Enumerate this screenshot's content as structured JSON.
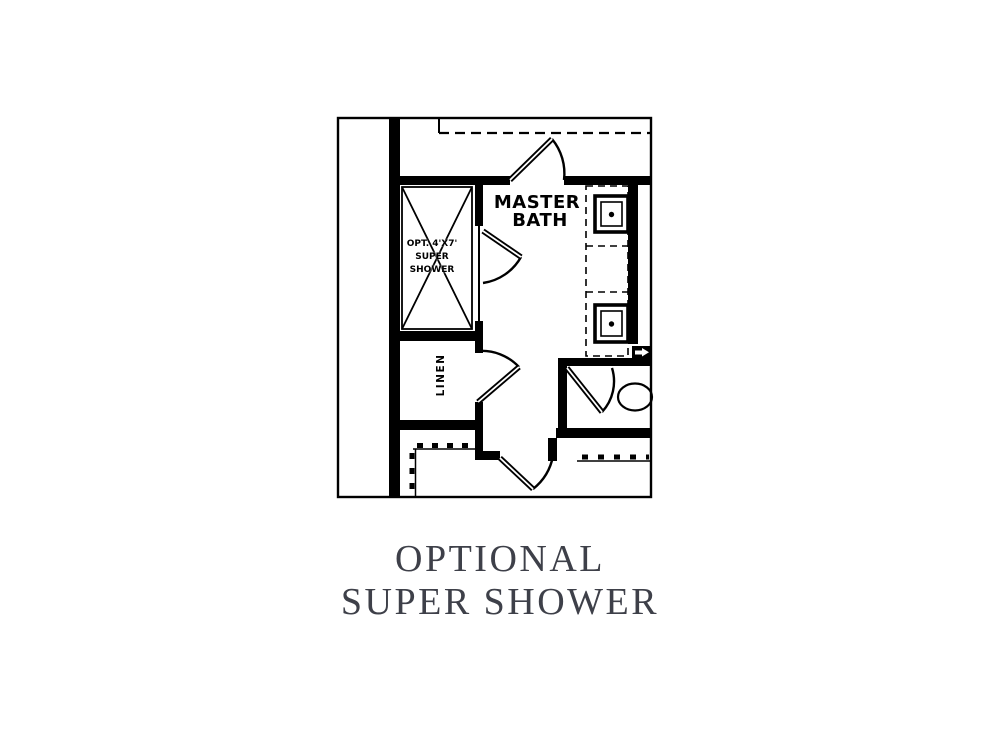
{
  "caption": {
    "line1": "OPTIONAL",
    "line2": "SUPER SHOWER",
    "color": "#3e4049"
  },
  "floor_plan": {
    "line_color": "#000000",
    "background": "#ffffff",
    "labels": {
      "room_line1": "MASTER",
      "room_line2": "BATH",
      "shower_line1": "OPT. 4'X7'",
      "shower_line2": "SUPER",
      "shower_line3": "SHOWER",
      "linen": "LINEN"
    },
    "fixtures": [
      "super-shower",
      "linen-closet",
      "vanity-sink-1",
      "vanity-sink-2",
      "toilet"
    ]
  }
}
